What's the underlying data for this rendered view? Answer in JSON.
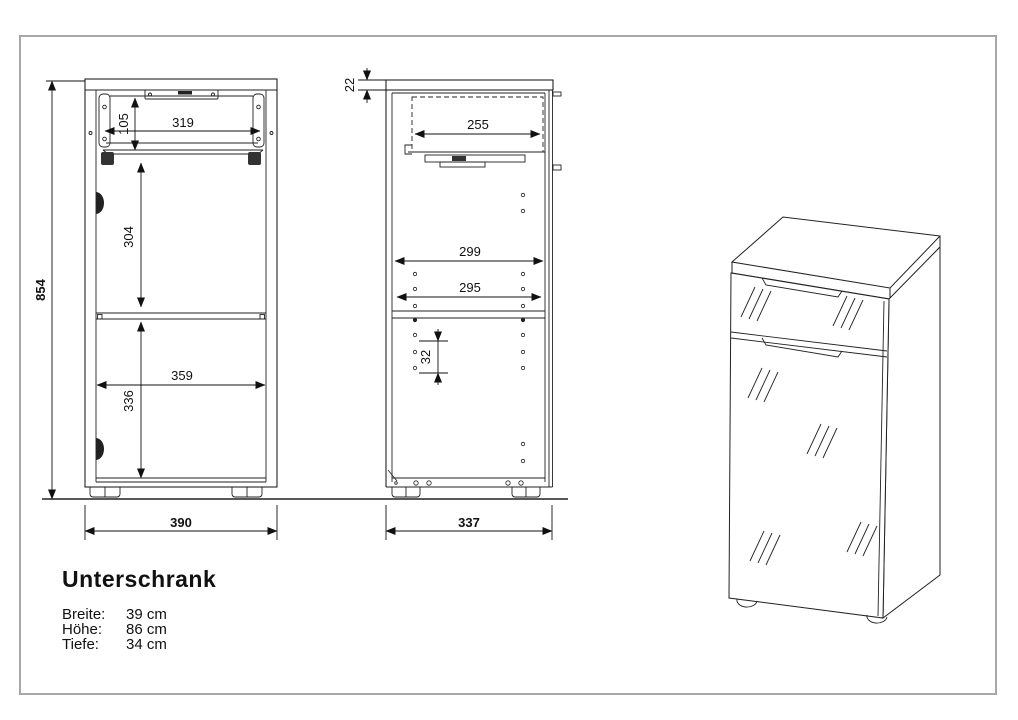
{
  "document": {
    "title": "Unterschrank",
    "specs": [
      {
        "label": "Breite:",
        "value": "39 cm"
      },
      {
        "label": "Höhe:",
        "value": "86 cm"
      },
      {
        "label": "Tiefe:",
        "value": "34 cm"
      }
    ]
  },
  "front_view": {
    "dims": {
      "overall_height": "854",
      "drawer_opening_height": "105",
      "drawer_opening_width": "319",
      "upper_compartment_height": "304",
      "shelf_width": "359",
      "lower_compartment_height": "336",
      "overall_width": "390"
    }
  },
  "side_view": {
    "dims": {
      "top_panel_thickness": "22",
      "drawer_depth": "255",
      "interior_depth_upper": "299",
      "interior_depth_shelf": "295",
      "shelf_pin_spacing": "32",
      "overall_depth": "337"
    }
  },
  "colors": {
    "line": "#222222",
    "dimension_line": "#111111",
    "border": "#a8a8a8",
    "background": "#ffffff"
  }
}
